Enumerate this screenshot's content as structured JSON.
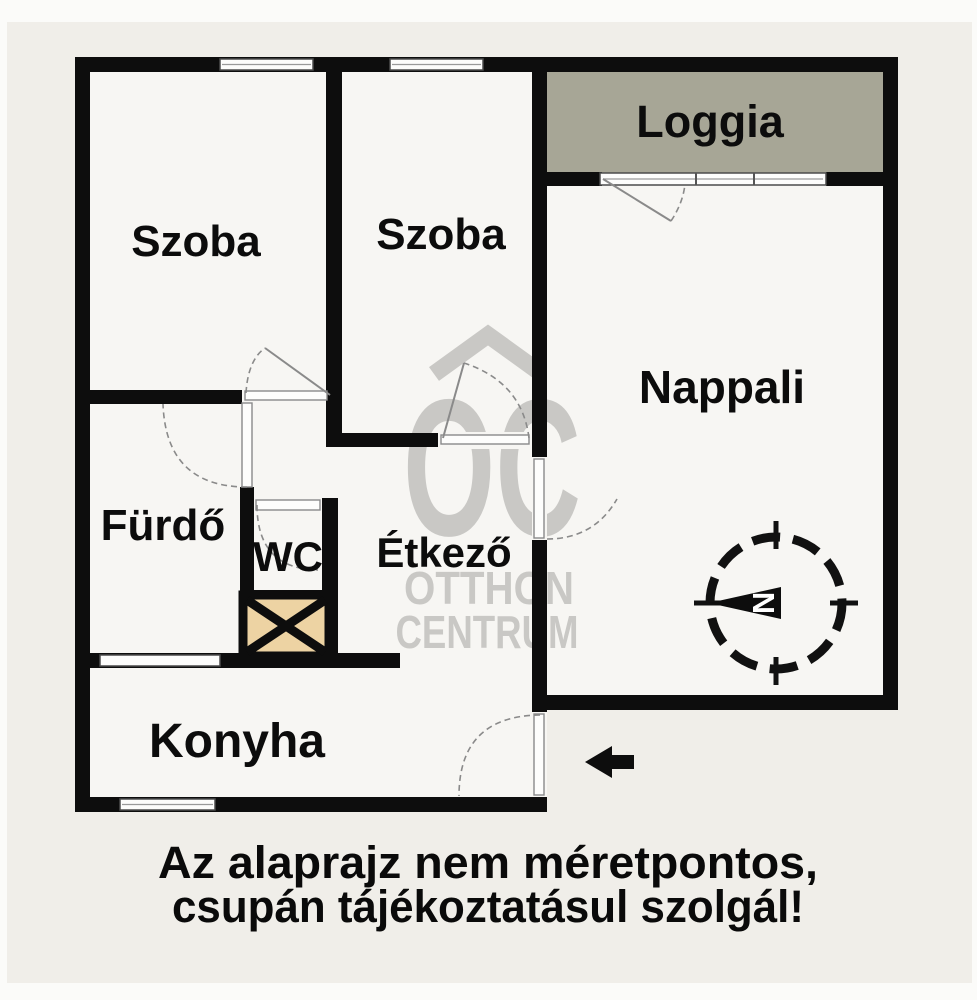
{
  "rooms": {
    "szoba1": "Szoba",
    "szoba2": "Szoba",
    "loggia": "Loggia",
    "nappali": "Nappali",
    "furdo": "Fürdő",
    "wc": "WC",
    "etkezo": "Étkező",
    "konyha": "Konyha"
  },
  "compass": {
    "north_letter": "N"
  },
  "watermark": {
    "monogram": "OC",
    "name_line1": "OTTHON",
    "name_line2": "CENTRUM"
  },
  "disclaimer": {
    "line1": "Az alaprajz nem méretpontos,",
    "line2": "csupán tájékoztatásul szolgál!"
  },
  "colors": {
    "background": "#f0eee9",
    "margin": "#fbfbf9",
    "floor": "#f7f6f3",
    "wall": "#0d0d0d",
    "loggia_fill": "#a7a696",
    "shaft_fill": "#edd3a3",
    "watermark": "#c9c8c5",
    "window_line": "#4c4c4c",
    "door_line": "#8a8a8a",
    "label": "#0c0c0c"
  }
}
